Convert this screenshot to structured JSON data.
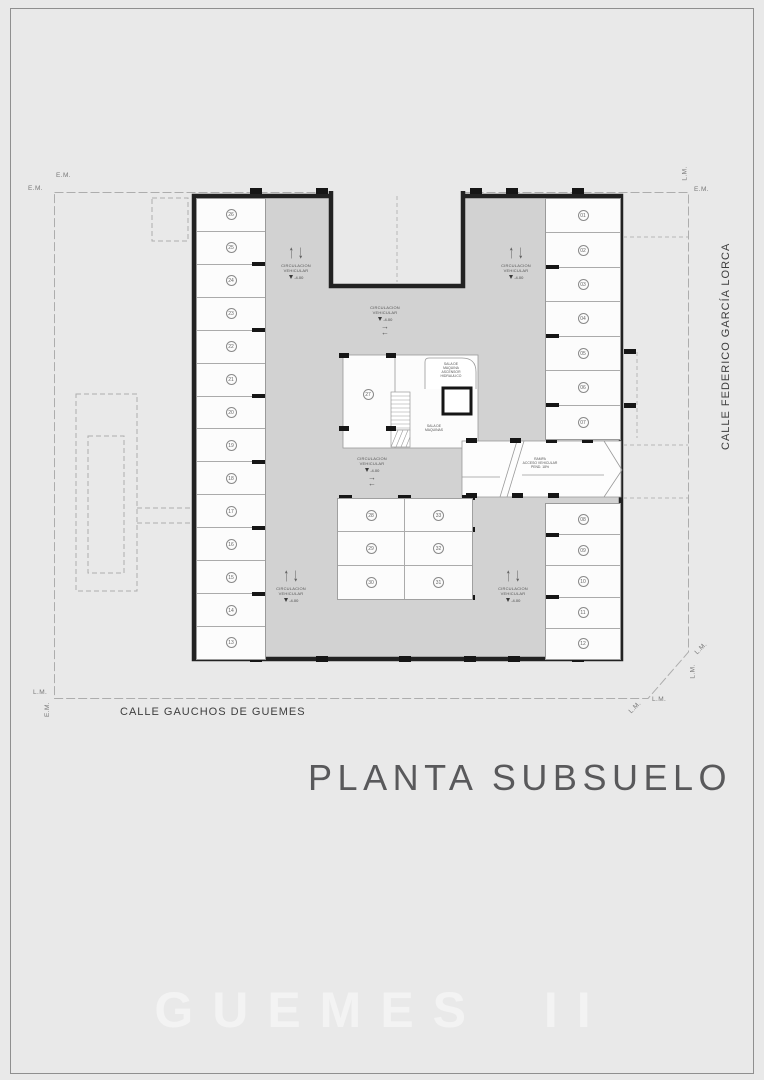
{
  "title_block": {
    "plan_title": "PLANTA SUBSUELO",
    "project_name": "GUEMES II"
  },
  "streets": {
    "bottom": "CALLE GAUCHOS DE GUEMES",
    "right": "CALLE FEDERICO GARCÍA LORCA"
  },
  "boundary": {
    "em": "E.M.",
    "lm": "L.M."
  },
  "circulation": {
    "line1": "CIRCULACION",
    "line2": "VEHICULAR",
    "level": "-4.00"
  },
  "rooms": {
    "elevator_machine": [
      "SALA DE",
      "MAQUINA",
      "ASCENSOR",
      "HIDRAULICO"
    ],
    "machine_room": [
      "SALA DE",
      "MAQUINAS"
    ],
    "ramp": [
      "RAMPA",
      "ACCESO VEHICULAR",
      "PEND. 18%"
    ]
  },
  "stalls": {
    "left_column": [
      "26",
      "25",
      "24",
      "23",
      "22",
      "21",
      "20",
      "19",
      "18",
      "17",
      "16",
      "15",
      "14",
      "13"
    ],
    "right_column_top": [
      "01",
      "02",
      "03",
      "04",
      "05",
      "06",
      "07"
    ],
    "right_column_bottom": [
      "08",
      "09",
      "10",
      "11",
      "12"
    ],
    "center_single": "27",
    "center_grid": [
      [
        "28",
        "33"
      ],
      [
        "29",
        "32"
      ],
      [
        "30",
        "31"
      ]
    ]
  },
  "colors": {
    "page_bg": "#e9e9e9",
    "driveway": "#d2d2d2",
    "stall": "#fcfcfc",
    "wall": "#1f1f1f",
    "title_text": "#59595b",
    "project_text": "#f3f3f3"
  }
}
